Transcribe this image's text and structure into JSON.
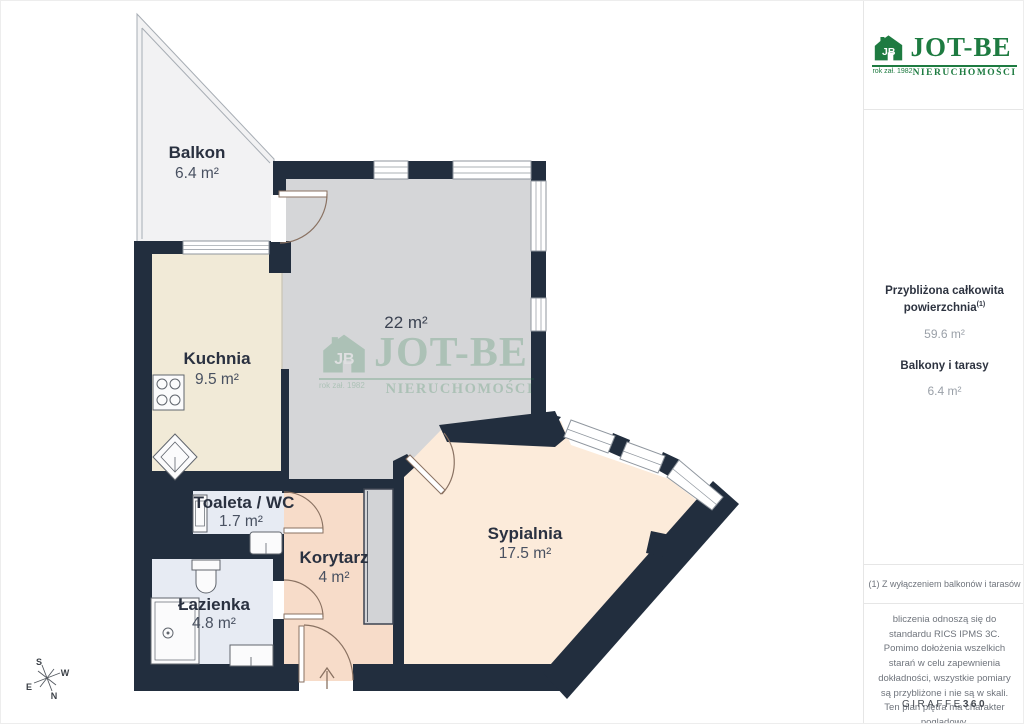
{
  "branding": {
    "title": "JOT-BE",
    "subtitle": "NIERUCHOMOŚCI",
    "year": "rok zał. 1982",
    "monogram": "JB",
    "green": "#1e7b41"
  },
  "sidebar": {
    "total_area_label": "Przybliżona całkowita powierzchnia",
    "total_area_sup": "(1)",
    "total_area_value": "59.6 m²",
    "balconies_label": "Balkony i tarasy",
    "balconies_value": "6.4 m²",
    "footnote": "(1) Z wyłączeniem balkonów i tarasów",
    "disclaimer": "bliczenia odnoszą się do standardu RICS IPMS 3C. Pomimo dołożenia wszelkich starań w celu zapewnienia dokładności, wszystkie pomiary są przybliżone i nie są w skali. Ten plan piętra ma charakter poglądowy.",
    "provider_regular": "GIRAFFE",
    "provider_bold": "360"
  },
  "rooms": {
    "balkon": {
      "name": "Balkon",
      "area": "6.4 m²"
    },
    "kuchnia": {
      "name": "Kuchnia",
      "area": "9.5 m²"
    },
    "salon": {
      "area": "22 m²"
    },
    "toaleta": {
      "name": "Toaleta / WC",
      "area": "1.7 m²"
    },
    "korytarz": {
      "name": "Korytarz",
      "area": "4 m²"
    },
    "lazienka": {
      "name": "Łazienka",
      "area": "4.8 m²"
    },
    "sypialnia": {
      "name": "Sypialnia",
      "area": "17.5 m²"
    }
  },
  "compass": {
    "n": "N",
    "s": "S",
    "e": "E",
    "w": "W"
  },
  "colors": {
    "wall": "#222e3e",
    "living_floor": "#d5d6d8",
    "kitchen_floor": "#f1ead7",
    "bedroom_floor": "#fcebda",
    "corridor_floor": "#f7dcc9",
    "bathroom_floor": "#e7ebf3",
    "balcony_floor": "#f2f2f3",
    "brand_green": "#1e7b41"
  }
}
